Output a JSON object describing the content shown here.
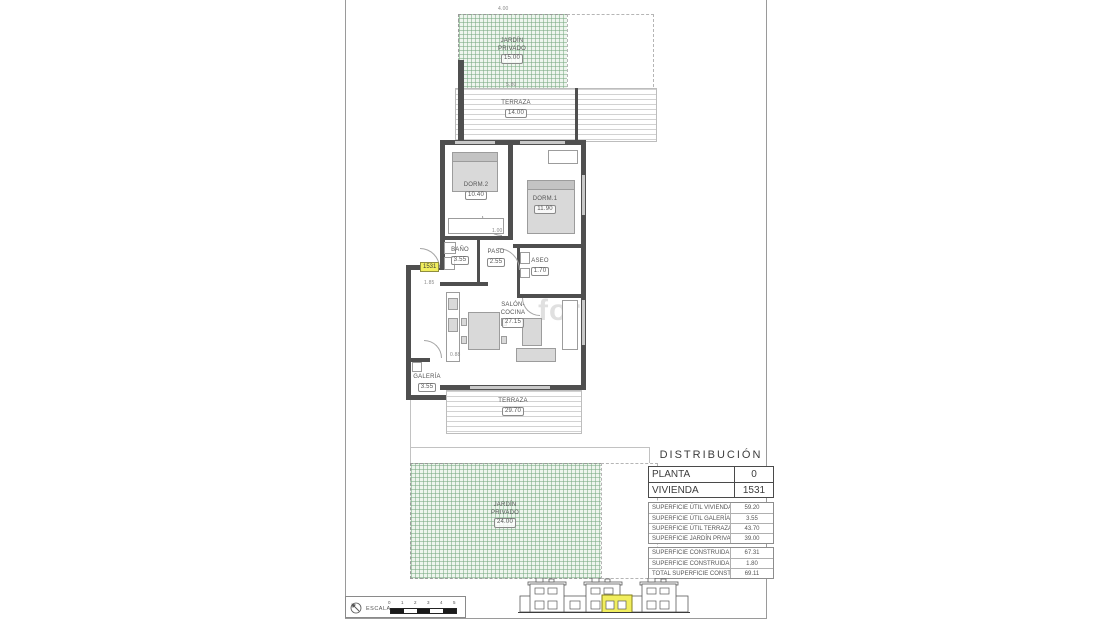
{
  "watermark": "for",
  "plan": {
    "unit_badge": "1531",
    "garden_top": {
      "line1": "JARDÍN",
      "line2": "PRIVADO",
      "value": "15.00"
    },
    "terrace_top": {
      "label": "TERRAZA",
      "value": "14.00"
    },
    "dorm2": {
      "label": "DORM.2",
      "value": "10.40"
    },
    "dorm1": {
      "label": "DORM.1",
      "value": "11.90"
    },
    "bano": {
      "label": "BAÑO",
      "value": "3.55"
    },
    "paso": {
      "label": "PASO",
      "value": "2.55"
    },
    "aseo": {
      "label": "ASEO",
      "value": "1.70"
    },
    "salon": {
      "line1": "SALÓN-",
      "line2": "COCINA",
      "value": "27.15"
    },
    "galeria": {
      "label": "GALERÍA",
      "value": "3.55"
    },
    "terrace_bottom": {
      "label": "TERRAZA",
      "value": "29.70"
    },
    "garden_bottom": {
      "line1": "JARDÍN",
      "line2": "PRIVADO",
      "value": "24.00"
    },
    "dims": {
      "d1": "4.00",
      "d2": "5.80",
      "d3": "1.00",
      "d4": "1.85",
      "d5": "0.88"
    }
  },
  "info_panel": {
    "title": "DISTRIBUCIÓN",
    "unit_rows": [
      {
        "label": "PLANTA",
        "value": "0"
      },
      {
        "label": "VIVIENDA",
        "value": "1531"
      }
    ],
    "areas_util": [
      {
        "label": "SUPERFICIE ÚTIL VIVIENDA",
        "value": "59.20"
      },
      {
        "label": "SUPERFICIE ÚTIL GALERÍA",
        "value": "3.55"
      },
      {
        "label": "SUPERFICIE ÚTIL TERRAZA",
        "value": "43.70"
      },
      {
        "label": "SUPERFICIE JARDÍN PRIVADO",
        "value": "39.00"
      }
    ],
    "areas_built": [
      {
        "label": "SUPERFICIE CONSTRUIDA VIVIENDA",
        "value": "67.31"
      },
      {
        "label": "SUPERFICIE CONSTRUIDA EL. COMUNES",
        "value": "1.80"
      },
      {
        "label": "TOTAL SUPERFICIE CONSTRUIDA",
        "value": "69.11"
      }
    ]
  },
  "footer": {
    "scale_label": "ESCALA",
    "scale_ticks": [
      "0",
      "1",
      "2",
      "3",
      "4",
      "5"
    ]
  },
  "colors": {
    "garden_green": "#9dc3a4",
    "highlight_yellow": "#f1ee5e",
    "wall_dark": "#4f4f4f"
  }
}
